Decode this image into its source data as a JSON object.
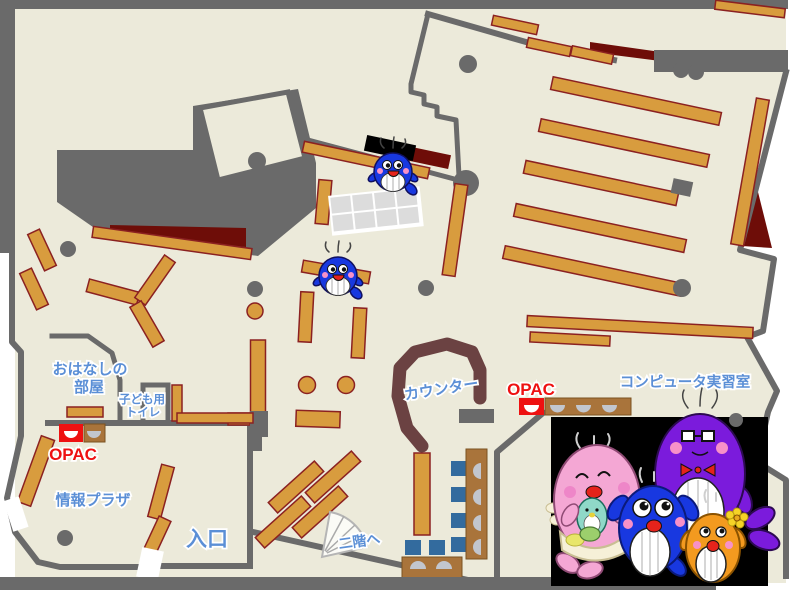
{
  "labels": {
    "ohanashi_1": "おはなしの",
    "ohanashi_2": "部屋",
    "toilet_1": "子ども用",
    "toilet_2": "トイレ",
    "opac_plaza": "OPAC",
    "opac_counter": "OPAC",
    "info_plaza": "情報プラザ",
    "entrance": "入口",
    "counter": "カウンター",
    "computer_room": "コンピュータ実習室",
    "second_floor": "二階へ"
  },
  "colors": {
    "floor": "#ECEADA",
    "wall_gray": "#6A6A6A",
    "bookshelf": "#D89C3E",
    "bookshelf_border": "#8B2121",
    "dark_red_area": "#6E0D08",
    "counter_brown": "#6B4242",
    "desk_brown": "#A9743B",
    "chair_blue": "#336B9E",
    "seat_gray": "#C2C6CE",
    "label_blue": "#5B8FD6",
    "opac_red": "#EE1111",
    "mascot_panel": "#000000"
  },
  "mascots": {
    "panel": "whale-family-illustration",
    "members": [
      "pink-mother-whale",
      "purple-father-whale",
      "blue-child-whale",
      "orange-child-whale",
      "teal-baby-whale"
    ],
    "map_sprites": [
      "blue-whale-sprite-top",
      "blue-whale-sprite-middle"
    ]
  }
}
